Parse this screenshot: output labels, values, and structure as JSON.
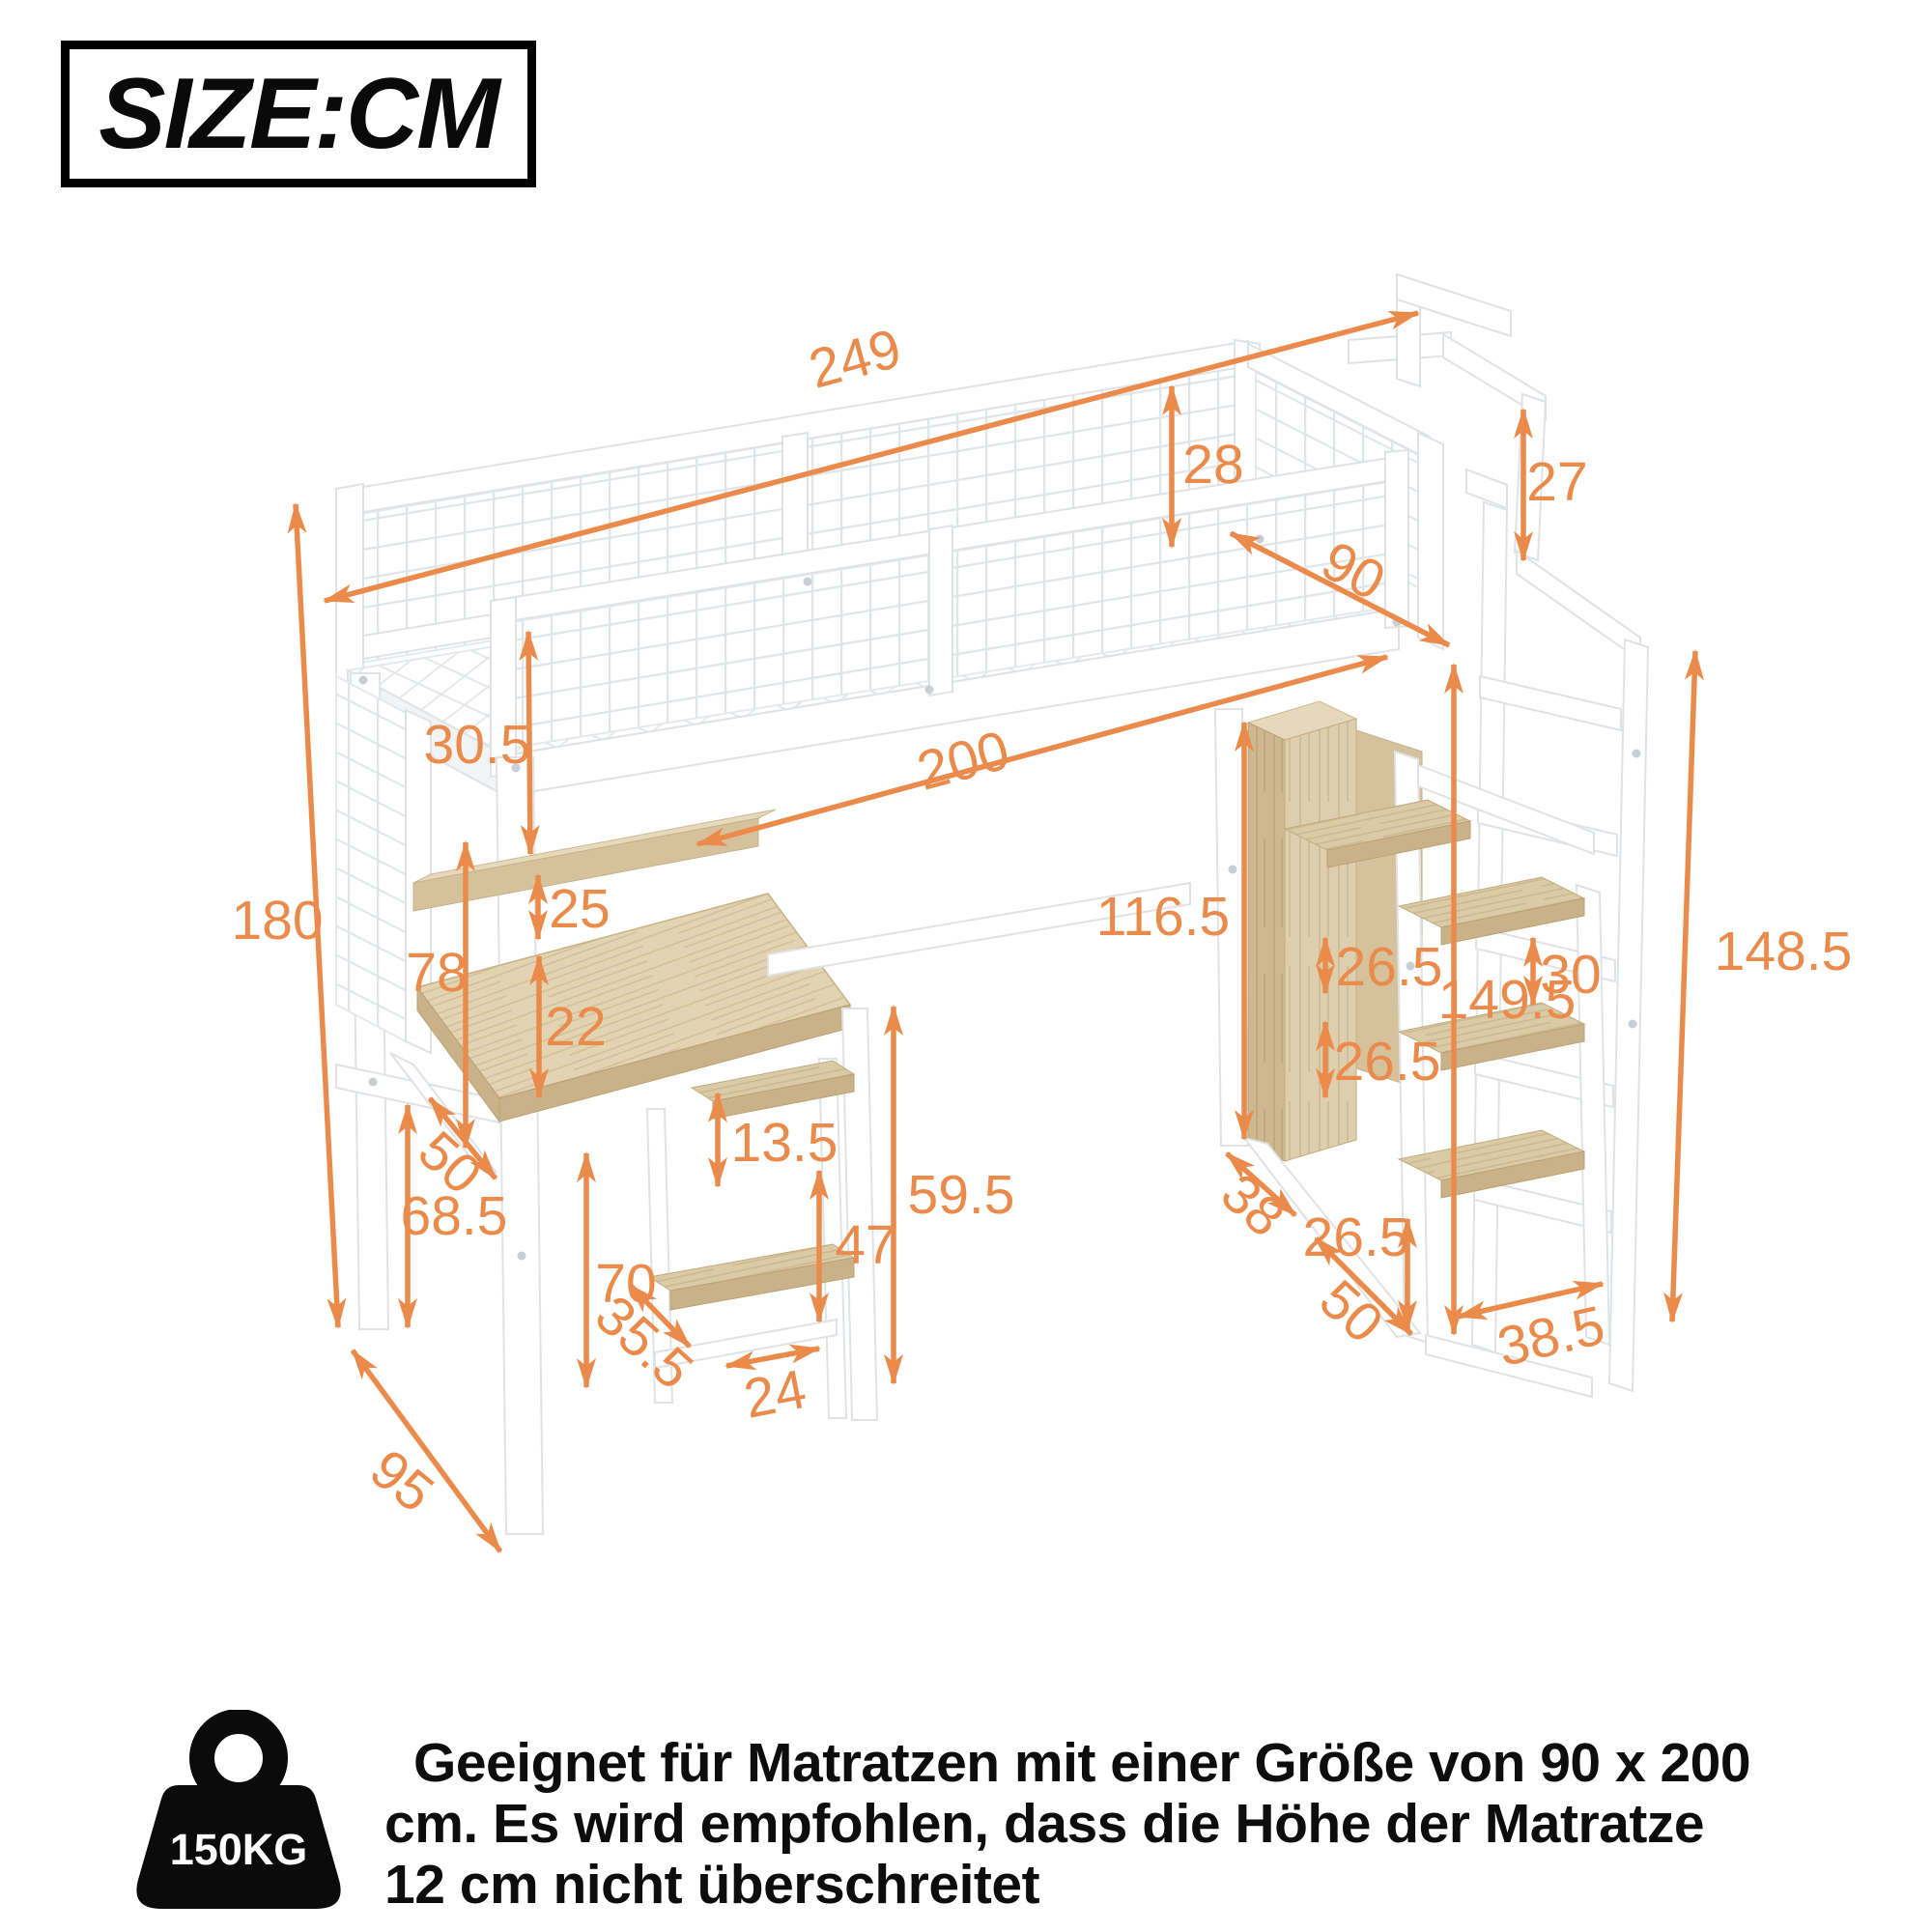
{
  "header": {
    "size_label": "SIZE:CM"
  },
  "footer": {
    "weight_badge": "150KG",
    "note_line1": "Geeignet für Matratzen mit einer Größe von 90 x 200",
    "note_line2": "cm. Es wird empfohlen, dass die Höhe der Matratze",
    "note_line3": "12 cm nicht überschreitet"
  },
  "colors": {
    "accent": "#EA8B4B",
    "frame_line": "#dfe3e6",
    "wood": "#d5c29c",
    "wood_dark": "#c9b288",
    "wood_light": "#e6d8ba",
    "text": "#111111"
  },
  "dimensions": {
    "total_length": "249",
    "guardrail_height": "28",
    "handrail_above": "27",
    "bed_width": "90",
    "frame_depth": "30.5",
    "inner_length": "200",
    "shelf_gap_upper_left": "25",
    "desk_clearance": "78",
    "shelf_gap_lower_left": "22",
    "desk_shelf_gap": "13.5",
    "desk_height": "59.5",
    "tower_gap": "47",
    "tower_height": "70",
    "tower_depth": "35.5",
    "tower_width": "24",
    "desk_depth": "50",
    "leg_height": "68.5",
    "total_height": "180",
    "floor_depth": "95",
    "underbed_height": "116.5",
    "cabinet_gap_top": "26.5",
    "cabinet_gap_mid": "26.5",
    "step_gap": "30",
    "stair_height": "149.5",
    "ladder_height": "148.5",
    "stair_depth": "38",
    "step_floor_gap": "26.5",
    "stair_width": "50",
    "ladder_width": "38.5"
  }
}
